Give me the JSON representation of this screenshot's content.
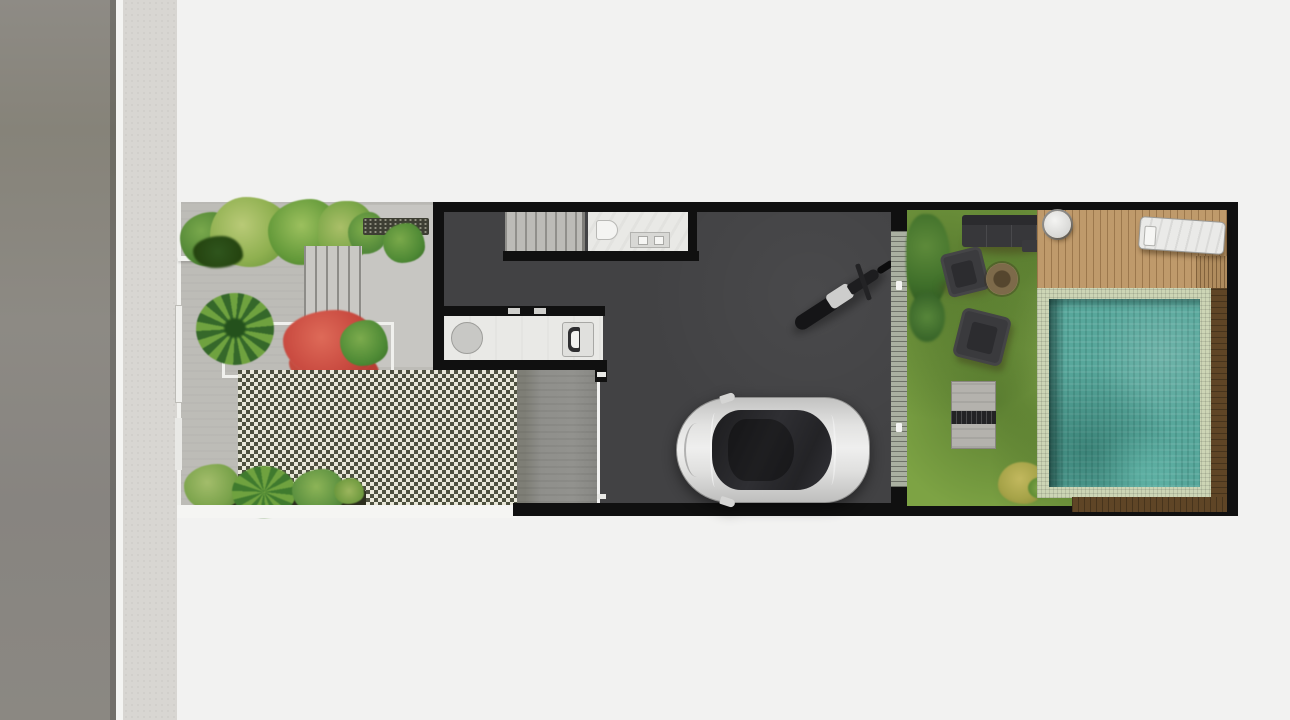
{
  "meta": {
    "title": "Top-view site plan rendering of a narrow row-house lot",
    "view": "top-down architectural plan",
    "visible_text": []
  },
  "palette": {
    "bg": "#f2f2f1",
    "road": "#8b8883",
    "curb": "#f4f4f2",
    "sidewalk": "#d8d6d2",
    "paving": "#bdbcb7",
    "wall": "#101010",
    "floor": "#424244",
    "room": "#e9e9e6",
    "checker_dark": "#4e5140",
    "checker_light": "#e9e8da",
    "lawn": "#7da344",
    "deck": "#bf9a6b",
    "pool_tile": "#ccd5b5",
    "pool_water": "#57a79b",
    "wood": "#5f4526",
    "plant_red": "#c8493f",
    "plant_green": "#5c9c3e",
    "furniture": "#37373a",
    "car_body": "#d9d9d8"
  },
  "regions": {
    "street": {
      "label": "street with curb and sidewalk"
    },
    "front_garden": {
      "label": "front garden and driveway",
      "features": [
        "shrub cluster",
        "gravel bed",
        "stepping-stone path",
        "planter with red flowering plant and palm",
        "grass-block paver driveway",
        "fern bed planter"
      ]
    },
    "house": {
      "label": "house interior with garage",
      "features": [
        "staircase",
        "bathroom with toilet and vanity",
        "kitchenette with round stool and sink",
        "parked motorcycle",
        "parked silver car",
        "sliding glass door to back garden",
        "concrete garage apron"
      ]
    },
    "back_garden": {
      "label": "back garden",
      "features": [
        "lawn",
        "outdoor sofa",
        "two lounge armchairs",
        "round fire pit",
        "garden bench unit",
        "yellow shrub",
        "wood deck",
        "round side table",
        "sun lounger",
        "swimming pool with tile surround and wood border"
      ]
    }
  }
}
